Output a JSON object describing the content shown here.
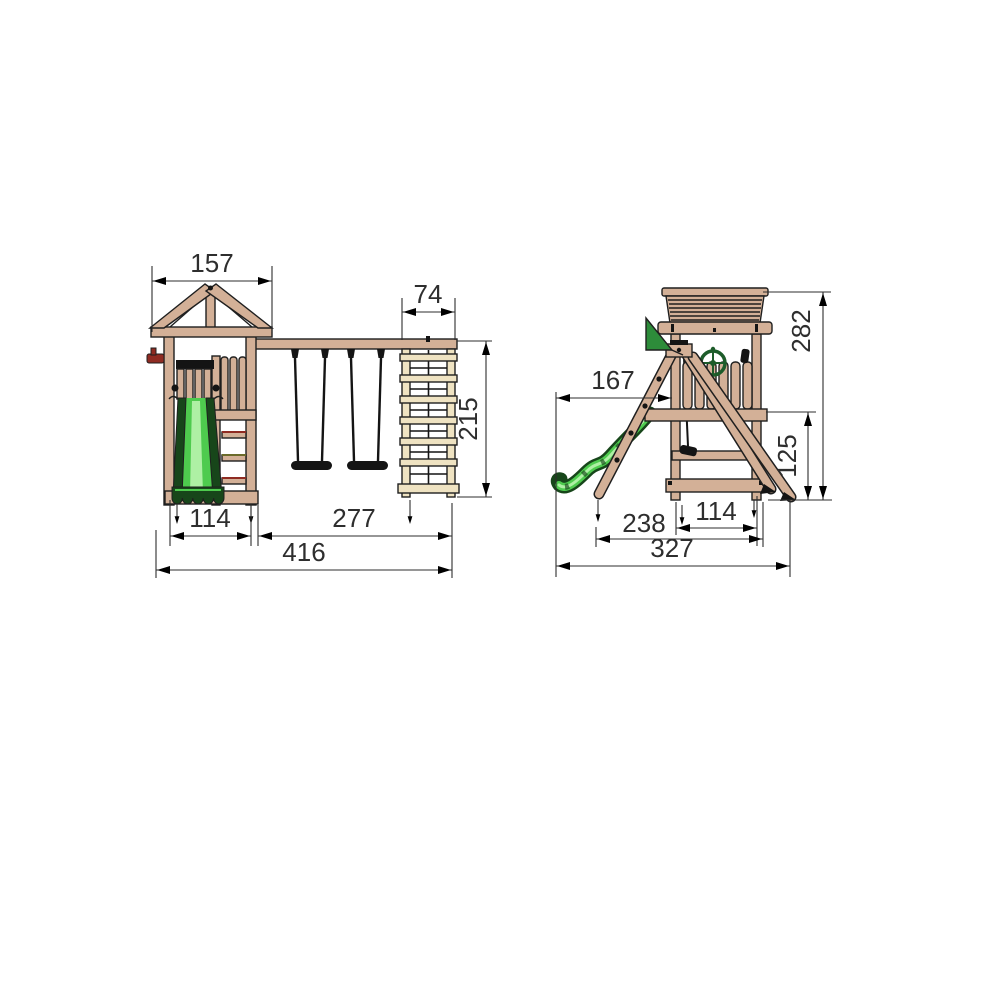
{
  "drawing": {
    "kind": "playground-set-dimension-drawing",
    "views": {
      "front": {
        "label": "front-elevation",
        "dims": {
          "roof_width": "157",
          "climber_width": "74",
          "height": "215",
          "tower_width": "114",
          "swing_section": "277",
          "total_width": "416"
        }
      },
      "side": {
        "label": "side-elevation",
        "dims": {
          "total_height": "282",
          "slide_reach": "167",
          "platform_height": "125",
          "frame_depth": "238",
          "tower_depth": "114",
          "total_depth": "327"
        }
      }
    }
  },
  "colors": {
    "wood": "#d3b097",
    "wood_dark": "#c39a7d",
    "cream": "#efe3c2",
    "outline": "#1f1f1f",
    "slide_green": "#4ecb4e",
    "slide_light": "#aef0a4",
    "slide_dark": "#17461a",
    "flag_green": "#2d8c3a",
    "wheel_green": "#1d5c2a",
    "accent_red": "#8f2b22",
    "dim": "#2e2e2e",
    "black": "#141414",
    "bg": "#ffffff"
  }
}
